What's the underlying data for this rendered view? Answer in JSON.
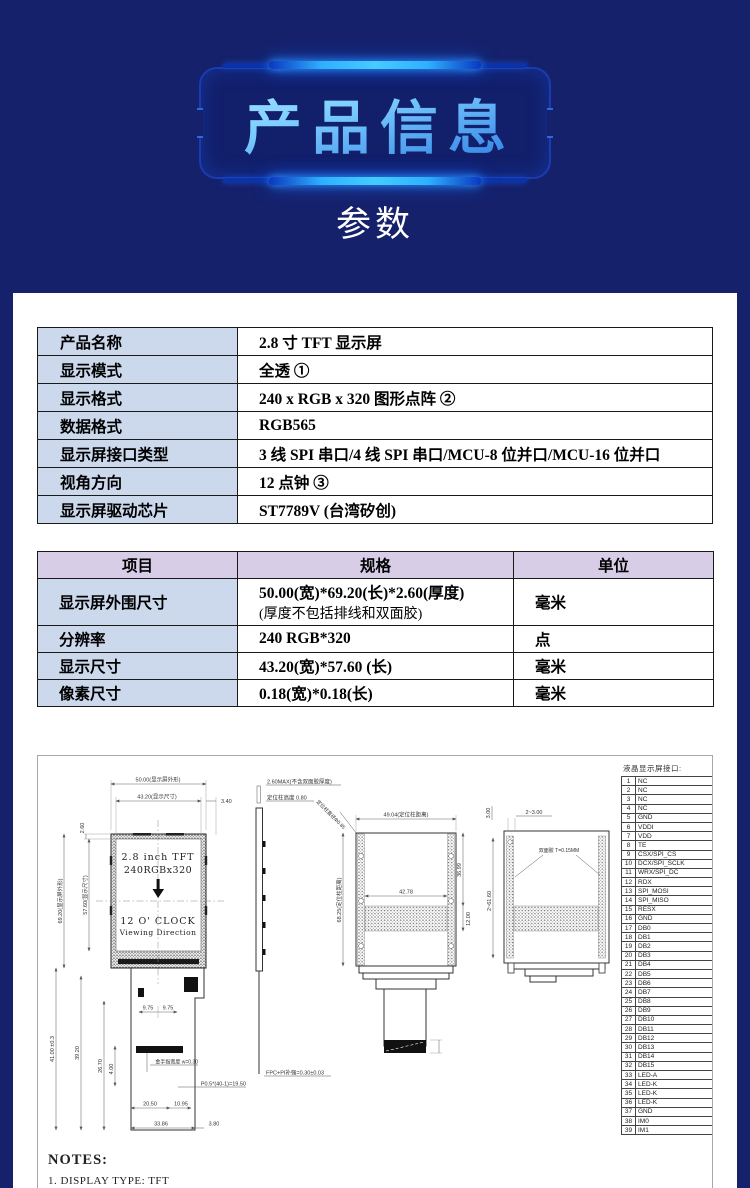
{
  "banner": {
    "title": "产品信息"
  },
  "section_heading": "参数",
  "colors": {
    "page_bg": "#15216b",
    "glow_blue": "#2fb0ff",
    "title_light": "#c2ecff",
    "title_deep": "#2f7fe6",
    "spec_key_bg": "#ccd8ec",
    "size_header_bg": "#d7cde6"
  },
  "spec_table": {
    "rows": [
      {
        "label": "产品名称",
        "value": "2.8 寸 TFT 显示屏"
      },
      {
        "label": "显示模式",
        "value": "全透 ①"
      },
      {
        "label": "显示格式",
        "value": "240 x RGB x 320 图形点阵 ②"
      },
      {
        "label": "数据格式",
        "value": "RGB565"
      },
      {
        "label": "显示屏接口类型",
        "value": "3 线 SPI 串口/4 线 SPI 串口/MCU-8 位并口/MCU-16 位并口"
      },
      {
        "label": "视角方向",
        "value": "12 点钟 ③"
      },
      {
        "label": "显示屏驱动芯片",
        "value": "ST7789V (台湾矽创)"
      }
    ]
  },
  "size_table": {
    "headers": [
      "项目",
      "规格",
      "单位"
    ],
    "rows": [
      {
        "item": "显示屏外围尺寸",
        "spec_line1": "50.00(宽)*69.20(长)*2.60(厚度)",
        "spec_line2": "(厚度不包括排线和双面胶)",
        "unit": "毫米"
      },
      {
        "item": "分辨率",
        "spec_line1": "240 RGB*320",
        "spec_line2": "",
        "unit": "点"
      },
      {
        "item": "显示尺寸",
        "spec_line1": "43.20(宽)*57.60 (长)",
        "spec_line2": "",
        "unit": "毫米"
      },
      {
        "item": "像素尺寸",
        "spec_line1": "0.18(宽)*0.18(长)",
        "spec_line2": "",
        "unit": "毫米"
      }
    ]
  },
  "drawing": {
    "front": {
      "dim_width_outer": "50.00(显示屏外形)",
      "dim_width_active": "43.20(显示尺寸)",
      "dim_right_margin": "3.40",
      "dim_top_margin": "2.60",
      "dim_height_outer": "69.20(显示屏外形)",
      "dim_height_active": "57.60(显示尺寸)",
      "line1": "2.8 inch TFT",
      "line2": "240RGBx320",
      "line3": "12 O' CLOCK",
      "line4": "Viewing Direction",
      "dim_tail_len": "41.00 ±0.3",
      "dim_39_20": "39.20",
      "dim_26_70": "26.70",
      "dim_9_75_l": "9.75",
      "dim_9_75_r": "9.75",
      "dim_4_00": "4.00",
      "goldfinger": "金手指宽度 w=0.30",
      "pitch": "P0.5*(40-1)=19.50",
      "dim_20_50": "20.50",
      "dim_10_95": "10.95",
      "dim_33_86": "33.86",
      "dim_3_80": "3.80"
    },
    "side": {
      "thickness": "2.60MAX(不含双面胶厚度)",
      "boss_height": "定位柱高度 0.80",
      "fpc": "FPC+PI补强=0.30±0.03"
    },
    "rear": {
      "boss_dia": "定位柱直径Φ0.85",
      "dim_width_boss": "49.04(定位柱距离)",
      "dim_height_boss": "68.25(定位柱距离)",
      "dim_42_78": "42.78",
      "dim_36_99": "36.99",
      "dim_12_00": "12.00"
    },
    "tape": {
      "dim_3_00": "3.00",
      "dim_2_3_00": "2~3.00",
      "dim_2_61_60": "2~61.60",
      "tape_label": "双面胶 T=0.15MM"
    },
    "notes_title": "NOTES:",
    "notes_line": "1. DISPLAY TYPE: TFT"
  },
  "pin_table": {
    "title": "液晶显示屏接口:",
    "pins": [
      {
        "no": "1",
        "name": "NC"
      },
      {
        "no": "2",
        "name": "NC"
      },
      {
        "no": "3",
        "name": "NC"
      },
      {
        "no": "4",
        "name": "NC"
      },
      {
        "no": "5",
        "name": "GND"
      },
      {
        "no": "6",
        "name": "VDDI"
      },
      {
        "no": "7",
        "name": "VDD"
      },
      {
        "no": "8",
        "name": "TE"
      },
      {
        "no": "9",
        "name": "CSX/SPI_CS"
      },
      {
        "no": "10",
        "name": "DCX/SPI_SCLK"
      },
      {
        "no": "11",
        "name": "WRX/SPI_DC"
      },
      {
        "no": "12",
        "name": "RDX"
      },
      {
        "no": "13",
        "name": "SPI_MOSI"
      },
      {
        "no": "14",
        "name": "SPI_MISO"
      },
      {
        "no": "15",
        "name": "RESX"
      },
      {
        "no": "16",
        "name": "GND"
      },
      {
        "no": "17",
        "name": "DB0"
      },
      {
        "no": "18",
        "name": "DB1"
      },
      {
        "no": "19",
        "name": "DB2"
      },
      {
        "no": "20",
        "name": "DB3"
      },
      {
        "no": "21",
        "name": "DB4"
      },
      {
        "no": "22",
        "name": "DB5"
      },
      {
        "no": "23",
        "name": "DB6"
      },
      {
        "no": "24",
        "name": "DB7"
      },
      {
        "no": "25",
        "name": "DB8"
      },
      {
        "no": "26",
        "name": "DB9"
      },
      {
        "no": "27",
        "name": "DB10"
      },
      {
        "no": "28",
        "name": "DB11"
      },
      {
        "no": "29",
        "name": "DB12"
      },
      {
        "no": "30",
        "name": "DB13"
      },
      {
        "no": "31",
        "name": "DB14"
      },
      {
        "no": "32",
        "name": "DB15"
      },
      {
        "no": "33",
        "name": "LED-A"
      },
      {
        "no": "34",
        "name": "LED-K"
      },
      {
        "no": "35",
        "name": "LED-K"
      },
      {
        "no": "36",
        "name": "LED-K"
      },
      {
        "no": "37",
        "name": "GND"
      },
      {
        "no": "38",
        "name": "IM0"
      },
      {
        "no": "39",
        "name": "IM1"
      }
    ]
  }
}
